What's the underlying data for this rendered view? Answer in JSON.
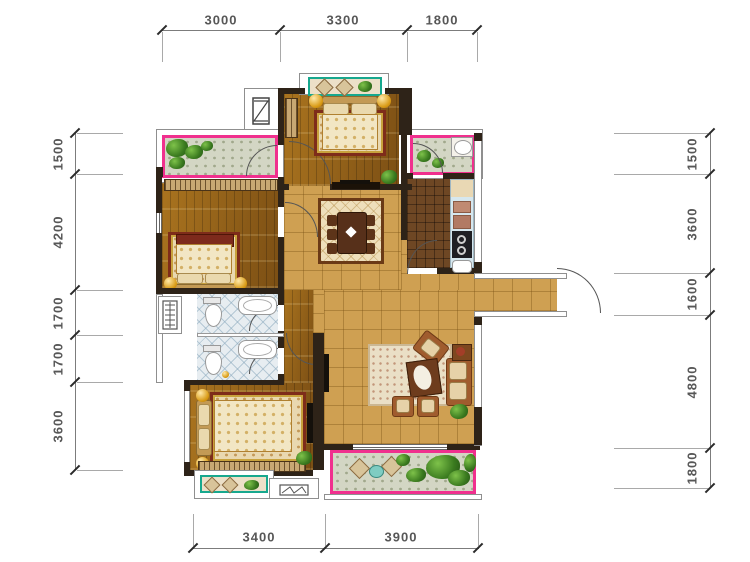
{
  "dims": {
    "top": [
      "3000",
      "3300",
      "1800"
    ],
    "left": [
      "1500",
      "4200",
      "1700",
      "1700",
      "3600"
    ],
    "right": [
      "1500",
      "3600",
      "1600",
      "4800",
      "1800"
    ],
    "bottom": [
      "3400",
      "3900"
    ]
  },
  "colors": {
    "balcony_border": "#f0308e",
    "bay_border": "#17a88e",
    "wall": "#2e2318"
  },
  "units": "mm"
}
